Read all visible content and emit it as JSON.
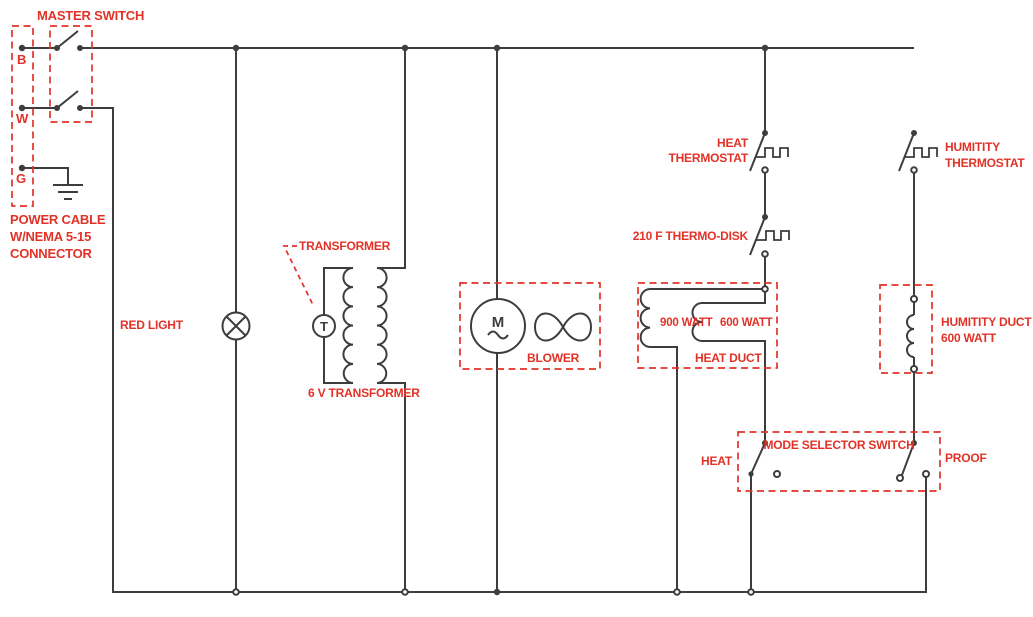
{
  "diagram": {
    "labels": {
      "master_switch": "MASTER SWITCH",
      "terminal_b": "B",
      "terminal_w": "W",
      "terminal_g": "G",
      "power_cable": [
        "POWER CABLE",
        "W/NEMA 5-15",
        "CONNECTOR"
      ],
      "red_light": "RED LIGHT",
      "transformer": "TRANSFORMER",
      "transformer_rating": "6 V TRANSFORMER",
      "blower": "BLOWER",
      "heat_thermostat": [
        "HEAT",
        "THERMOSTAT"
      ],
      "thermo_disk": "210 F THERMO-DISK",
      "heat_duct": "HEAT DUCT",
      "heat_element_left": "900 WATT",
      "heat_element_right": "600 WATT",
      "humidity_thermostat": [
        "HUMITITY",
        "THERMOSTAT"
      ],
      "humidity_duct": [
        "HUMITITY DUCT",
        "600 WATT"
      ],
      "mode_selector": "MODE SELECTOR SWITCH",
      "mode_heat": "HEAT",
      "mode_proof": "PROOF",
      "motor_letter": "M",
      "transformer_letter": "T"
    },
    "colors": {
      "label_red": "#e23227",
      "wire": "#3d3d3d",
      "background": "#ffffff"
    }
  }
}
